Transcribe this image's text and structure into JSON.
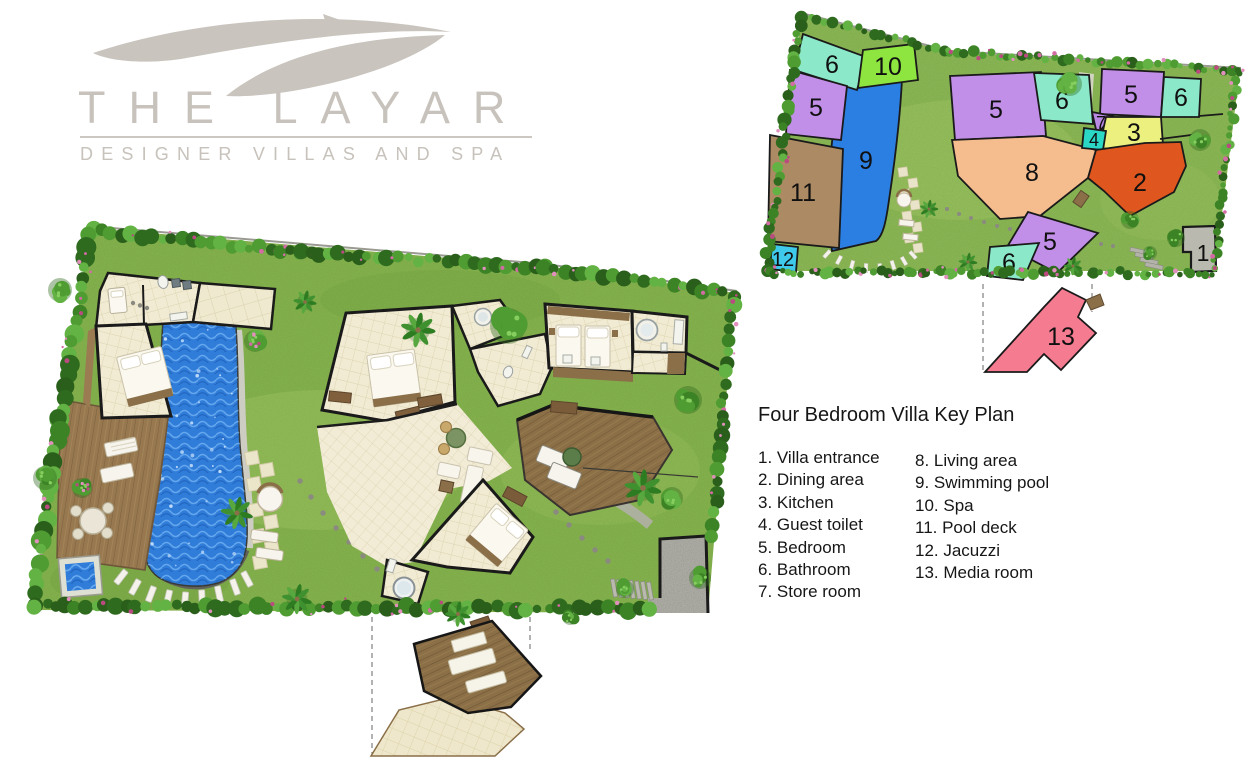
{
  "brand": {
    "name": "THE LAYAR",
    "tagline": "DESIGNER VILLAS AND SPA"
  },
  "legend": {
    "title": "Four Bedroom Villa Key Plan",
    "col1": [
      "1. Villa entrance",
      "2. Dining area",
      "3. Kitchen",
      "4. Guest toilet",
      "5. Bedroom",
      "6. Bathroom",
      "7. Store room"
    ],
    "col2": [
      "8. Living area",
      "9. Swimming pool",
      "10. Spa",
      "11. Pool deck",
      "12. Jacuzzi",
      "13. Media room"
    ]
  },
  "keyplan": {
    "rooms": [
      {
        "label": "6",
        "name": "bathroom",
        "color": "#8BE9C9"
      },
      {
        "label": "10",
        "name": "spa",
        "color": "#8FE53F"
      },
      {
        "label": "5",
        "name": "bedroom",
        "color": "#C28FE8"
      },
      {
        "label": "9",
        "name": "swimming-pool",
        "color": "#2B7EE2"
      },
      {
        "label": "11",
        "name": "pool-deck",
        "color": "#AC8A64"
      },
      {
        "label": "12",
        "name": "jacuzzi",
        "color": "#3FC9EA"
      },
      {
        "label": "5",
        "name": "bedroom",
        "color": "#C28FE8"
      },
      {
        "label": "6",
        "name": "bathroom",
        "color": "#8BE9C9"
      },
      {
        "label": "5",
        "name": "bedroom",
        "color": "#C28FE8"
      },
      {
        "label": "6",
        "name": "bathroom",
        "color": "#8BE9C9"
      },
      {
        "label": "7",
        "name": "store-room",
        "color": "#B98AE4"
      },
      {
        "label": "3",
        "name": "kitchen",
        "color": "#EBF07F"
      },
      {
        "label": "4",
        "name": "guest-toilet",
        "color": "#2BD8C6"
      },
      {
        "label": "8",
        "name": "living-area",
        "color": "#F5BC8E"
      },
      {
        "label": "2",
        "name": "dining-area",
        "color": "#E0561F"
      },
      {
        "label": "5",
        "name": "bedroom",
        "color": "#C28FE8"
      },
      {
        "label": "6",
        "name": "bathroom",
        "color": "#8BE9C9"
      },
      {
        "label": "1",
        "name": "villa-entrance",
        "color": "#B9B9B0"
      },
      {
        "label": "13",
        "name": "media-room",
        "color": "#F57B90"
      }
    ]
  },
  "palette": {
    "brand_gray": "#C7C2BB",
    "lawn": "#86B54E",
    "pool_water": "#2F7CD9",
    "deck_wood": "#97784F",
    "tile_floor": "#F1EBD3",
    "hedge_green": "#3C8326",
    "flower_pink": "#D873AA",
    "wall_black": "#1A1A1A",
    "driveway_gray": "#B7B7AF"
  }
}
